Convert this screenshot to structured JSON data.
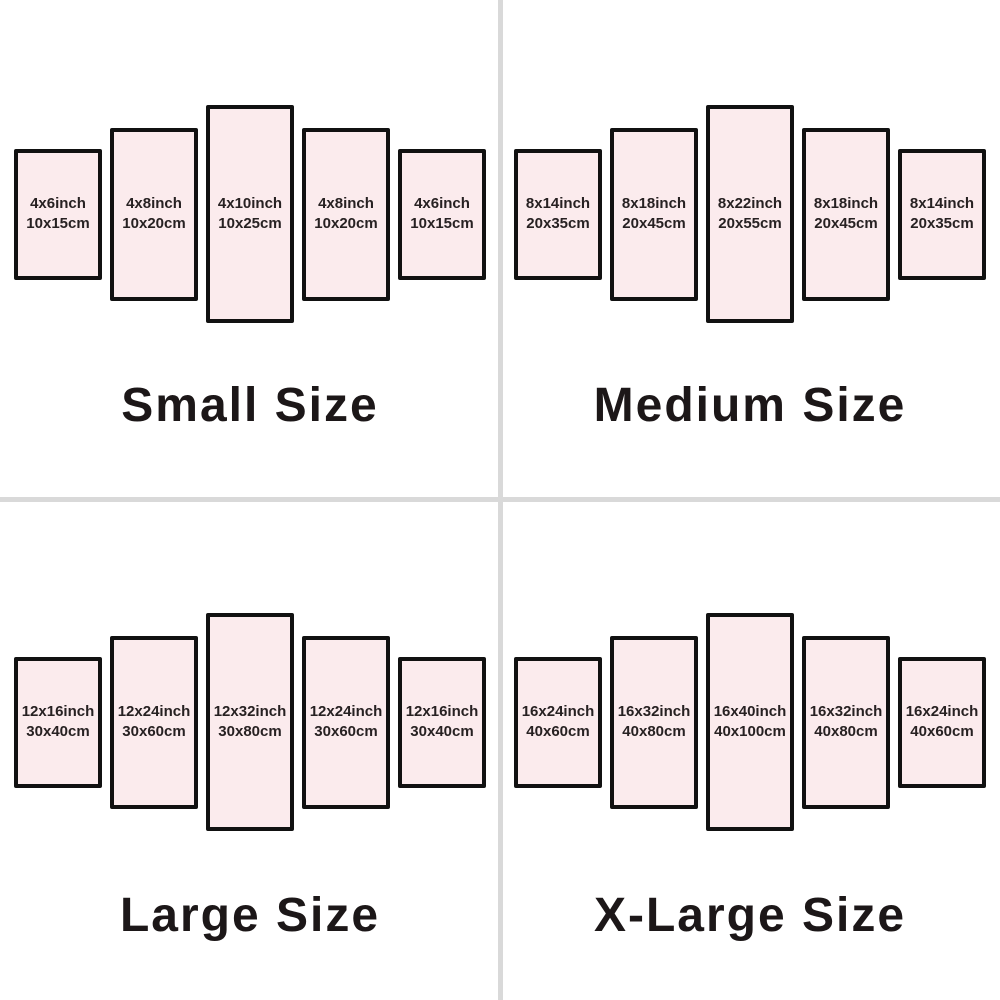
{
  "page": {
    "background": "#ffffff",
    "divider_color": "#d9d9d9"
  },
  "panel_style": {
    "fill": "#fbebed",
    "border": "#111111",
    "label_color": "#272122",
    "title_color": "#1c1718"
  },
  "quadrants": [
    {
      "title": "Small Size",
      "panels": [
        {
          "inch": "4x6inch",
          "cm": "10x15cm"
        },
        {
          "inch": "4x8inch",
          "cm": "10x20cm"
        },
        {
          "inch": "4x10inch",
          "cm": "10x25cm"
        },
        {
          "inch": "4x8inch",
          "cm": "10x20cm"
        },
        {
          "inch": "4x6inch",
          "cm": "10x15cm"
        }
      ]
    },
    {
      "title": "Medium Size",
      "panels": [
        {
          "inch": "8x14inch",
          "cm": "20x35cm"
        },
        {
          "inch": "8x18inch",
          "cm": "20x45cm"
        },
        {
          "inch": "8x22inch",
          "cm": "20x55cm"
        },
        {
          "inch": "8x18inch",
          "cm": "20x45cm"
        },
        {
          "inch": "8x14inch",
          "cm": "20x35cm"
        }
      ]
    },
    {
      "title": "Large Size",
      "panels": [
        {
          "inch": "12x16inch",
          "cm": "30x40cm"
        },
        {
          "inch": "12x24inch",
          "cm": "30x60cm"
        },
        {
          "inch": "12x32inch",
          "cm": "30x80cm"
        },
        {
          "inch": "12x24inch",
          "cm": "30x60cm"
        },
        {
          "inch": "12x16inch",
          "cm": "30x40cm"
        }
      ]
    },
    {
      "title": "X-Large Size",
      "panels": [
        {
          "inch": "16x24inch",
          "cm": "40x60cm"
        },
        {
          "inch": "16x32inch",
          "cm": "40x80cm"
        },
        {
          "inch": "16x40inch",
          "cm": "40x100cm"
        },
        {
          "inch": "16x32inch",
          "cm": "40x80cm"
        },
        {
          "inch": "16x24inch",
          "cm": "40x60cm"
        }
      ]
    }
  ]
}
